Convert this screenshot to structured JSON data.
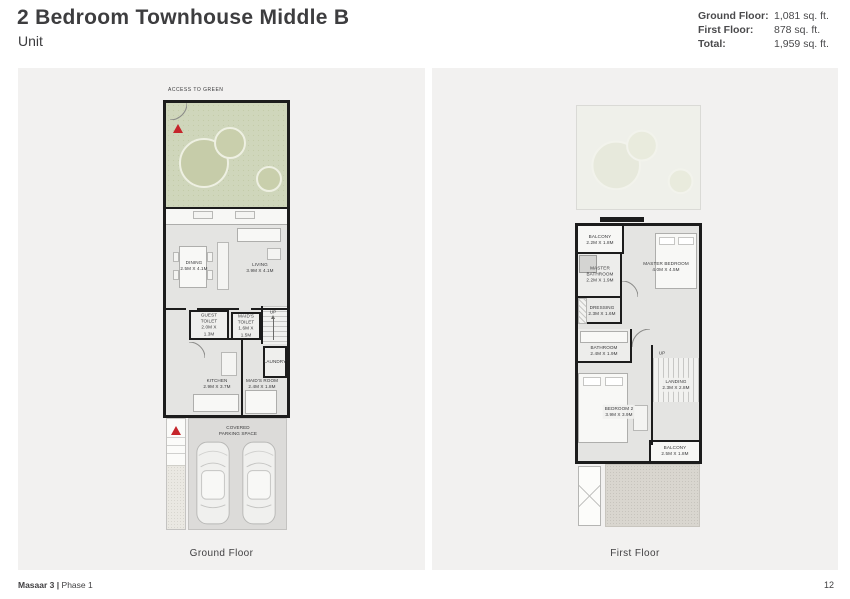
{
  "header": {
    "title": "2 Bedroom Townhouse Middle B",
    "subtitle": "Unit",
    "stats": [
      {
        "label": "Ground Floor:",
        "value": "1,081 sq. ft."
      },
      {
        "label": "First Floor:",
        "value": "878 sq. ft."
      },
      {
        "label": "Total:",
        "value": "1,959 sq. ft."
      }
    ]
  },
  "ground_floor": {
    "caption": "Ground Floor",
    "access_label": "ACCESS TO GREEN",
    "stairs_label": "UP",
    "rooms": {
      "dining": {
        "name": "DINING",
        "dims": "2.5M X 4.1M"
      },
      "living": {
        "name": "LIVING",
        "dims": "3.9M X 4.1M"
      },
      "guest_toilet": {
        "name": "GUEST TOILET",
        "dims": "2.0M X 1.3M"
      },
      "maids_toilet": {
        "name": "MAID'S TOILET",
        "dims": "1.6M X 1.5M"
      },
      "laundry": {
        "name": "LAUNDRY"
      },
      "kitchen": {
        "name": "KITCHEN",
        "dims": "2.9M X 3.7M"
      },
      "maids_room": {
        "name": "MAID'S ROOM",
        "dims": "2.4M X 1.8M"
      },
      "parking": {
        "name": "COVERED PARKING SPACE"
      }
    }
  },
  "first_floor": {
    "caption": "First Floor",
    "stairs_label": "UP",
    "rooms": {
      "balcony_front": {
        "name": "BALCONY",
        "dims": "2.2M X 1.8M"
      },
      "master_bathroom": {
        "name": "MASTER BATHROOM",
        "dims": "2.2M X 1.9M"
      },
      "master_bedroom": {
        "name": "MASTER BEDROOM",
        "dims": "4.0M X 4.5M"
      },
      "dressing": {
        "name": "DRESSING",
        "dims": "2.3M X 1.6M"
      },
      "bathroom": {
        "name": "BATHROOM",
        "dims": "2.4M X 1.9M"
      },
      "landing": {
        "name": "LANDING",
        "dims": "2.3M X 2.8M"
      },
      "bedroom_2": {
        "name": "BEDROOM 2",
        "dims": "3.9M X 3.9M"
      },
      "balcony_rear": {
        "name": "BALCONY",
        "dims": "2.5M X 1.8M"
      }
    }
  },
  "footer": {
    "project": "Masaar 3",
    "separator": "|",
    "phase": "Phase 1",
    "page": "12"
  },
  "colors": {
    "accent_red": "#c5252b",
    "garden_green": "#cfd6bb",
    "wall": "#1c1c1c",
    "panel_bg": "#f2f1f0",
    "floor": "#e4e4e2"
  }
}
